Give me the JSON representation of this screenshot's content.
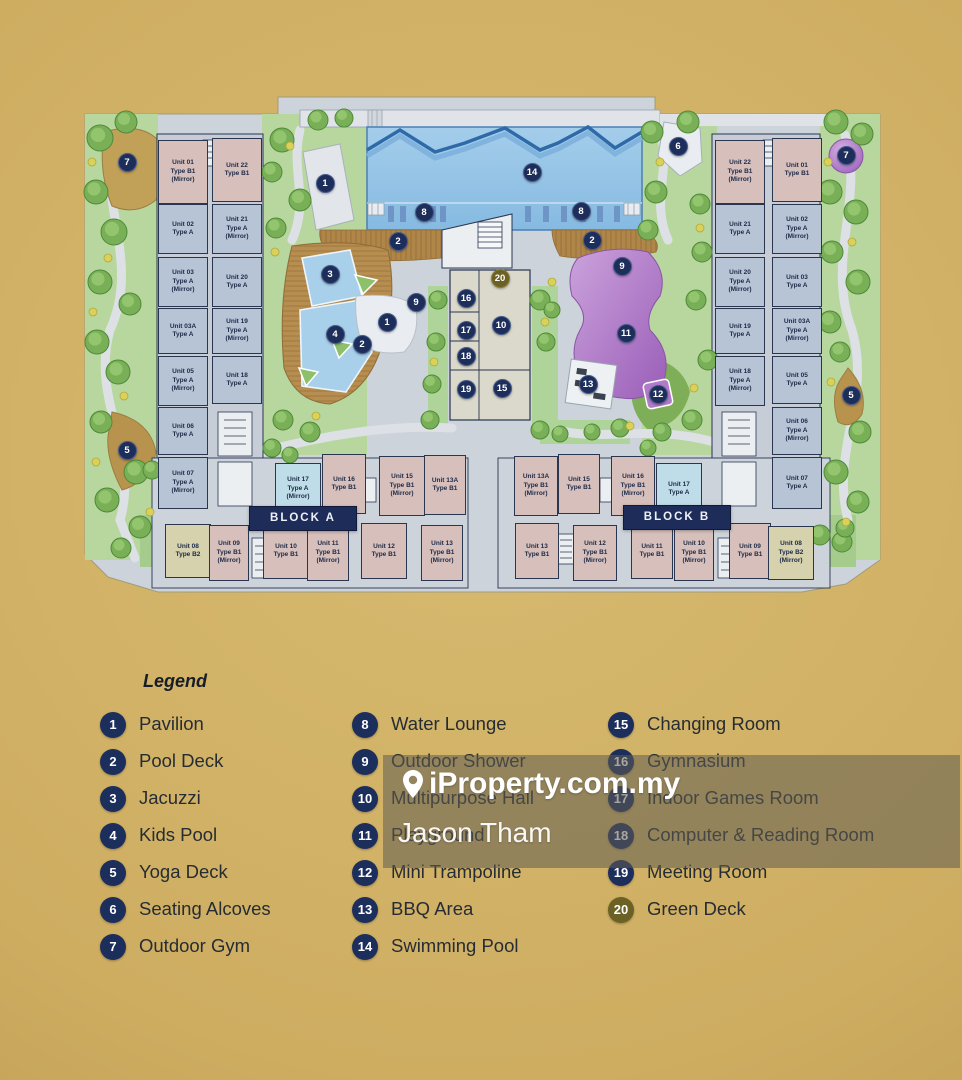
{
  "watermark": {
    "brand": "iProperty.com.my",
    "agent": "Jason Tham"
  },
  "legend": {
    "title": "Legend",
    "columns": [
      {
        "items": [
          {
            "num": "1",
            "label": "Pavilion"
          },
          {
            "num": "2",
            "label": "Pool Deck"
          },
          {
            "num": "3",
            "label": "Jacuzzi"
          },
          {
            "num": "4",
            "label": "Kids Pool"
          },
          {
            "num": "5",
            "label": "Yoga Deck"
          },
          {
            "num": "6",
            "label": "Seating Alcoves"
          },
          {
            "num": "7",
            "label": "Outdoor Gym"
          }
        ]
      },
      {
        "items": [
          {
            "num": "8",
            "label": "Water Lounge"
          },
          {
            "num": "9",
            "label": "Outdoor Shower"
          },
          {
            "num": "10",
            "label": "Multipurpose Hall"
          },
          {
            "num": "11",
            "label": "Playground"
          },
          {
            "num": "12",
            "label": "Mini Trampoline"
          },
          {
            "num": "13",
            "label": "BBQ Area"
          },
          {
            "num": "14",
            "label": "Swimming Pool"
          }
        ]
      },
      {
        "items": [
          {
            "num": "15",
            "label": "Changing Room"
          },
          {
            "num": "16",
            "label": "Gymnasium"
          },
          {
            "num": "17",
            "label": "Indoor Games Room"
          },
          {
            "num": "18",
            "label": "Computer & Reading Room"
          },
          {
            "num": "19",
            "label": "Meeting Room"
          },
          {
            "num": "20",
            "label": "Green Deck",
            "accent": true
          }
        ]
      }
    ]
  },
  "plan": {
    "blocks": [
      {
        "label": "BLOCK A",
        "x": 303,
        "y": 519
      },
      {
        "label": "BLOCK B",
        "x": 677,
        "y": 518
      }
    ],
    "markers": [
      {
        "n": "7",
        "x": 127,
        "y": 162
      },
      {
        "n": "1",
        "x": 325,
        "y": 183
      },
      {
        "n": "14",
        "x": 532,
        "y": 172
      },
      {
        "n": "8",
        "x": 424,
        "y": 212
      },
      {
        "n": "8",
        "x": 581,
        "y": 211
      },
      {
        "n": "2",
        "x": 398,
        "y": 241
      },
      {
        "n": "2",
        "x": 592,
        "y": 240
      },
      {
        "n": "9",
        "x": 622,
        "y": 266
      },
      {
        "n": "3",
        "x": 330,
        "y": 274
      },
      {
        "n": "20",
        "x": 500,
        "y": 278,
        "a": true
      },
      {
        "n": "16",
        "x": 466,
        "y": 298
      },
      {
        "n": "9",
        "x": 416,
        "y": 302
      },
      {
        "n": "1",
        "x": 387,
        "y": 322
      },
      {
        "n": "10",
        "x": 501,
        "y": 325
      },
      {
        "n": "17",
        "x": 466,
        "y": 330
      },
      {
        "n": "11",
        "x": 626,
        "y": 333
      },
      {
        "n": "4",
        "x": 335,
        "y": 334
      },
      {
        "n": "2",
        "x": 362,
        "y": 344
      },
      {
        "n": "18",
        "x": 466,
        "y": 356
      },
      {
        "n": "13",
        "x": 588,
        "y": 384
      },
      {
        "n": "15",
        "x": 502,
        "y": 388
      },
      {
        "n": "19",
        "x": 466,
        "y": 389
      },
      {
        "n": "12",
        "x": 658,
        "y": 394
      },
      {
        "n": "6",
        "x": 678,
        "y": 146
      },
      {
        "n": "7",
        "x": 846,
        "y": 155
      },
      {
        "n": "5",
        "x": 851,
        "y": 395
      },
      {
        "n": "5",
        "x": 127,
        "y": 450
      }
    ],
    "units": [
      {
        "n": "Unit 01",
        "t": "Type B1",
        "m": 1,
        "x": 183,
        "y": 172,
        "w": 50,
        "h": 64,
        "f": "B1"
      },
      {
        "n": "Unit 22",
        "t": "Type B1",
        "m": 0,
        "x": 237,
        "y": 170,
        "w": 50,
        "h": 64,
        "f": "B1"
      },
      {
        "n": "Unit 02",
        "t": "Type A",
        "m": 0,
        "x": 183,
        "y": 229,
        "w": 50,
        "h": 50,
        "f": "A"
      },
      {
        "n": "Unit 21",
        "t": "Type A",
        "m": 1,
        "x": 237,
        "y": 229,
        "w": 50,
        "h": 50,
        "f": "A"
      },
      {
        "n": "Unit 03",
        "t": "Type A",
        "m": 1,
        "x": 183,
        "y": 282,
        "w": 50,
        "h": 50,
        "f": "A"
      },
      {
        "n": "Unit 20",
        "t": "Type A",
        "m": 0,
        "x": 237,
        "y": 282,
        "w": 50,
        "h": 50,
        "f": "A"
      },
      {
        "n": "Unit 03A",
        "t": "Type A",
        "m": 0,
        "x": 183,
        "y": 331,
        "w": 50,
        "h": 46,
        "f": "A"
      },
      {
        "n": "Unit 19",
        "t": "Type A",
        "m": 1,
        "x": 237,
        "y": 331,
        "w": 50,
        "h": 46,
        "f": "A"
      },
      {
        "n": "Unit 05",
        "t": "Type A",
        "m": 1,
        "x": 183,
        "y": 381,
        "w": 50,
        "h": 50,
        "f": "A"
      },
      {
        "n": "Unit 18",
        "t": "Type A",
        "m": 0,
        "x": 237,
        "y": 380,
        "w": 50,
        "h": 48,
        "f": "A"
      },
      {
        "n": "Unit 06",
        "t": "Type A",
        "m": 0,
        "x": 183,
        "y": 431,
        "w": 50,
        "h": 48,
        "f": "A"
      },
      {
        "n": "Unit 07",
        "t": "Type A",
        "m": 1,
        "x": 183,
        "y": 483,
        "w": 50,
        "h": 52,
        "f": "A"
      },
      {
        "n": "Unit 22",
        "t": "Type B1",
        "m": 1,
        "x": 740,
        "y": 172,
        "w": 50,
        "h": 64,
        "f": "B1"
      },
      {
        "n": "Unit 01",
        "t": "Type B1",
        "m": 0,
        "x": 797,
        "y": 170,
        "w": 50,
        "h": 64,
        "f": "B1"
      },
      {
        "n": "Unit 21",
        "t": "Type A",
        "m": 0,
        "x": 740,
        "y": 229,
        "w": 50,
        "h": 50,
        "f": "A"
      },
      {
        "n": "Unit 02",
        "t": "Type A",
        "m": 1,
        "x": 797,
        "y": 229,
        "w": 50,
        "h": 50,
        "f": "A"
      },
      {
        "n": "Unit 20",
        "t": "Type A",
        "m": 1,
        "x": 740,
        "y": 282,
        "w": 50,
        "h": 50,
        "f": "A"
      },
      {
        "n": "Unit 03",
        "t": "Type A",
        "m": 0,
        "x": 797,
        "y": 282,
        "w": 50,
        "h": 50,
        "f": "A"
      },
      {
        "n": "Unit 19",
        "t": "Type A",
        "m": 0,
        "x": 740,
        "y": 331,
        "w": 50,
        "h": 46,
        "f": "A"
      },
      {
        "n": "Unit 03A",
        "t": "Type A",
        "m": 1,
        "x": 797,
        "y": 331,
        "w": 50,
        "h": 46,
        "f": "A"
      },
      {
        "n": "Unit 18",
        "t": "Type A",
        "m": 1,
        "x": 740,
        "y": 381,
        "w": 50,
        "h": 50,
        "f": "A"
      },
      {
        "n": "Unit 05",
        "t": "Type A",
        "m": 0,
        "x": 797,
        "y": 380,
        "w": 50,
        "h": 48,
        "f": "A"
      },
      {
        "n": "Unit 06",
        "t": "Type A",
        "m": 1,
        "x": 797,
        "y": 431,
        "w": 50,
        "h": 48,
        "f": "A"
      },
      {
        "n": "Unit 07",
        "t": "Type A",
        "m": 0,
        "x": 797,
        "y": 483,
        "w": 50,
        "h": 52,
        "f": "A"
      },
      {
        "n": "Unit 17",
        "t": "Type A",
        "m": 1,
        "x": 298,
        "y": 489,
        "w": 46,
        "h": 52,
        "f": "AH"
      },
      {
        "n": "Unit 16",
        "t": "Type B1",
        "m": 0,
        "x": 344,
        "y": 484,
        "w": 44,
        "h": 60,
        "f": "B1"
      },
      {
        "n": "Unit 15",
        "t": "Type B1",
        "m": 1,
        "x": 402,
        "y": 486,
        "w": 46,
        "h": 60,
        "f": "B1"
      },
      {
        "n": "Unit 13A",
        "t": "Type B1",
        "m": 0,
        "x": 445,
        "y": 485,
        "w": 42,
        "h": 60,
        "f": "B1"
      },
      {
        "n": "Unit 08",
        "t": "Type B2",
        "m": 0,
        "x": 188,
        "y": 551,
        "w": 46,
        "h": 54,
        "f": "B2"
      },
      {
        "n": "Unit 09",
        "t": "Type B1",
        "m": 1,
        "x": 229,
        "y": 553,
        "w": 40,
        "h": 56,
        "f": "B1"
      },
      {
        "n": "Unit 10",
        "t": "Type B1",
        "m": 0,
        "x": 286,
        "y": 551,
        "w": 46,
        "h": 56,
        "f": "B1"
      },
      {
        "n": "Unit 11",
        "t": "Type B1",
        "m": 1,
        "x": 328,
        "y": 553,
        "w": 42,
        "h": 56,
        "f": "B1"
      },
      {
        "n": "Unit 12",
        "t": "Type B1",
        "m": 0,
        "x": 384,
        "y": 551,
        "w": 46,
        "h": 56,
        "f": "B1"
      },
      {
        "n": "Unit 13",
        "t": "Type B1",
        "m": 1,
        "x": 442,
        "y": 553,
        "w": 42,
        "h": 56,
        "f": "B1"
      },
      {
        "n": "Unit 13A",
        "t": "Type B1",
        "m": 1,
        "x": 536,
        "y": 486,
        "w": 44,
        "h": 60,
        "f": "B1"
      },
      {
        "n": "Unit 15",
        "t": "Type B1",
        "m": 0,
        "x": 579,
        "y": 484,
        "w": 42,
        "h": 60,
        "f": "B1"
      },
      {
        "n": "Unit 16",
        "t": "Type B1",
        "m": 1,
        "x": 633,
        "y": 486,
        "w": 44,
        "h": 60,
        "f": "B1"
      },
      {
        "n": "Unit 17",
        "t": "Type A",
        "m": 0,
        "x": 679,
        "y": 489,
        "w": 46,
        "h": 52,
        "f": "AH"
      },
      {
        "n": "Unit 13",
        "t": "Type B1",
        "m": 0,
        "x": 537,
        "y": 551,
        "w": 44,
        "h": 56,
        "f": "B1"
      },
      {
        "n": "Unit 12",
        "t": "Type B1",
        "m": 1,
        "x": 595,
        "y": 553,
        "w": 44,
        "h": 56,
        "f": "B1"
      },
      {
        "n": "Unit 11",
        "t": "Type B1",
        "m": 0,
        "x": 652,
        "y": 551,
        "w": 42,
        "h": 56,
        "f": "B1"
      },
      {
        "n": "Unit 10",
        "t": "Type B1",
        "m": 1,
        "x": 694,
        "y": 553,
        "w": 40,
        "h": 56,
        "f": "B1"
      },
      {
        "n": "Unit 09",
        "t": "Type B1",
        "m": 0,
        "x": 750,
        "y": 551,
        "w": 42,
        "h": 56,
        "f": "B1"
      },
      {
        "n": "Unit 08",
        "t": "Type B2",
        "m": 1,
        "x": 791,
        "y": 553,
        "w": 46,
        "h": 54,
        "f": "B2"
      }
    ]
  }
}
